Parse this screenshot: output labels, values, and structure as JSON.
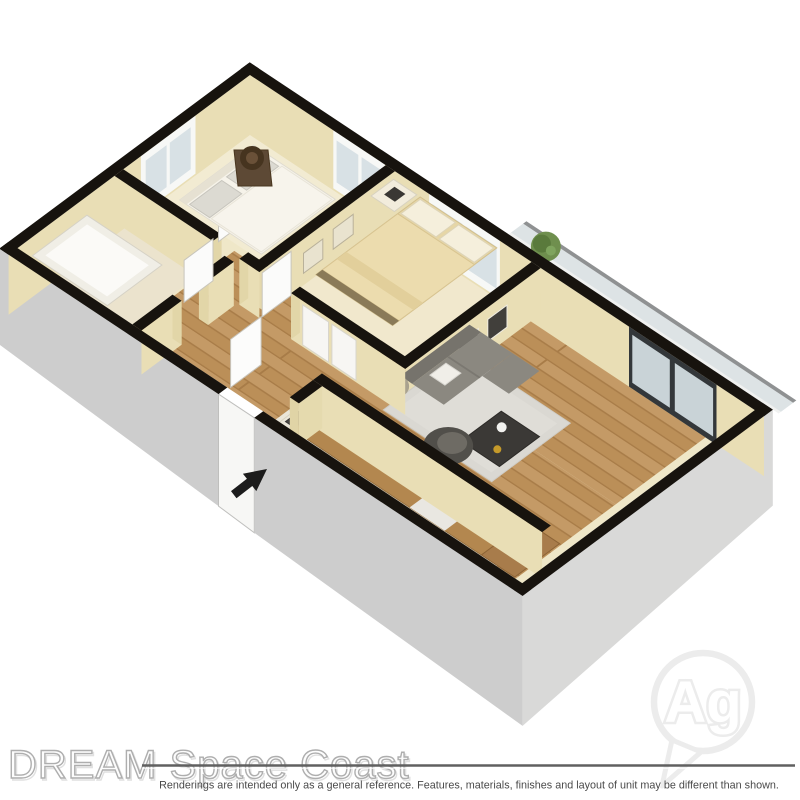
{
  "branding": {
    "watermark": "DREAM Space Coast",
    "provider_logo": "Ag"
  },
  "disclaimer": "Renderings are intended only as a general reference. Features, materials, finishes and layout of unit may be different than shown.",
  "floorplan": {
    "type": "3d-isometric-floorplan-rendering",
    "rooms": [
      "bedroom-1",
      "bedroom-2",
      "bathroom",
      "hallway",
      "living-room",
      "dining-area",
      "kitchen",
      "balcony",
      "entry"
    ],
    "colors": {
      "background": "#ffffff",
      "wall_top": "#17130e",
      "wall_face": "#e9deb5",
      "wall_face_dark": "#e2d6a8",
      "floor_base": "#efe7c8",
      "carpet1": "#f2ebd2",
      "carpet2": "#f1e8cd",
      "bath_floor": "#ebe3cd",
      "exterior_left": "#cdcdcd",
      "exterior_right": "#d9d9d8",
      "door_white": "#f7f7f5",
      "window_white": "#f7f8f6",
      "glass": "#d8e1e5",
      "slider_frame": "#33373a",
      "slider_glass": "#c9d3d7",
      "counter": "#f9f7f1",
      "cabinet": "#b3874f",
      "sofa": "#8b8880",
      "sofa_back": "#76736c",
      "rug": "#dad8d2",
      "dark_table": "#3b3936",
      "dining_table": "#4a4845",
      "plant": "#6f8f4e",
      "bed1": "#f6f3ea",
      "bed2_duvet": "#ecdcae",
      "tub": "#fbfaf7",
      "arrow": "#1c1c1c",
      "watermark_line": "#606060",
      "disclaimer_text": "#4a4a4a",
      "logo_outline": "#ececec"
    }
  }
}
